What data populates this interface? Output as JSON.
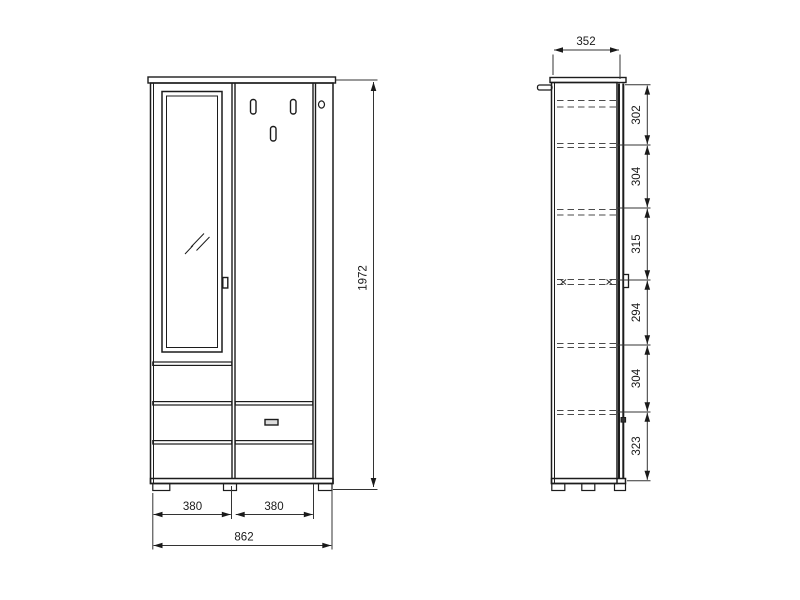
{
  "drawing": {
    "front_view": {
      "height": "1972",
      "left_section_width": "380",
      "right_section_width": "380",
      "total_width": "862"
    },
    "side_view": {
      "depth": "352",
      "segments_top_to_bottom": [
        "302",
        "304",
        "315",
        "294",
        "304",
        "323"
      ]
    }
  }
}
